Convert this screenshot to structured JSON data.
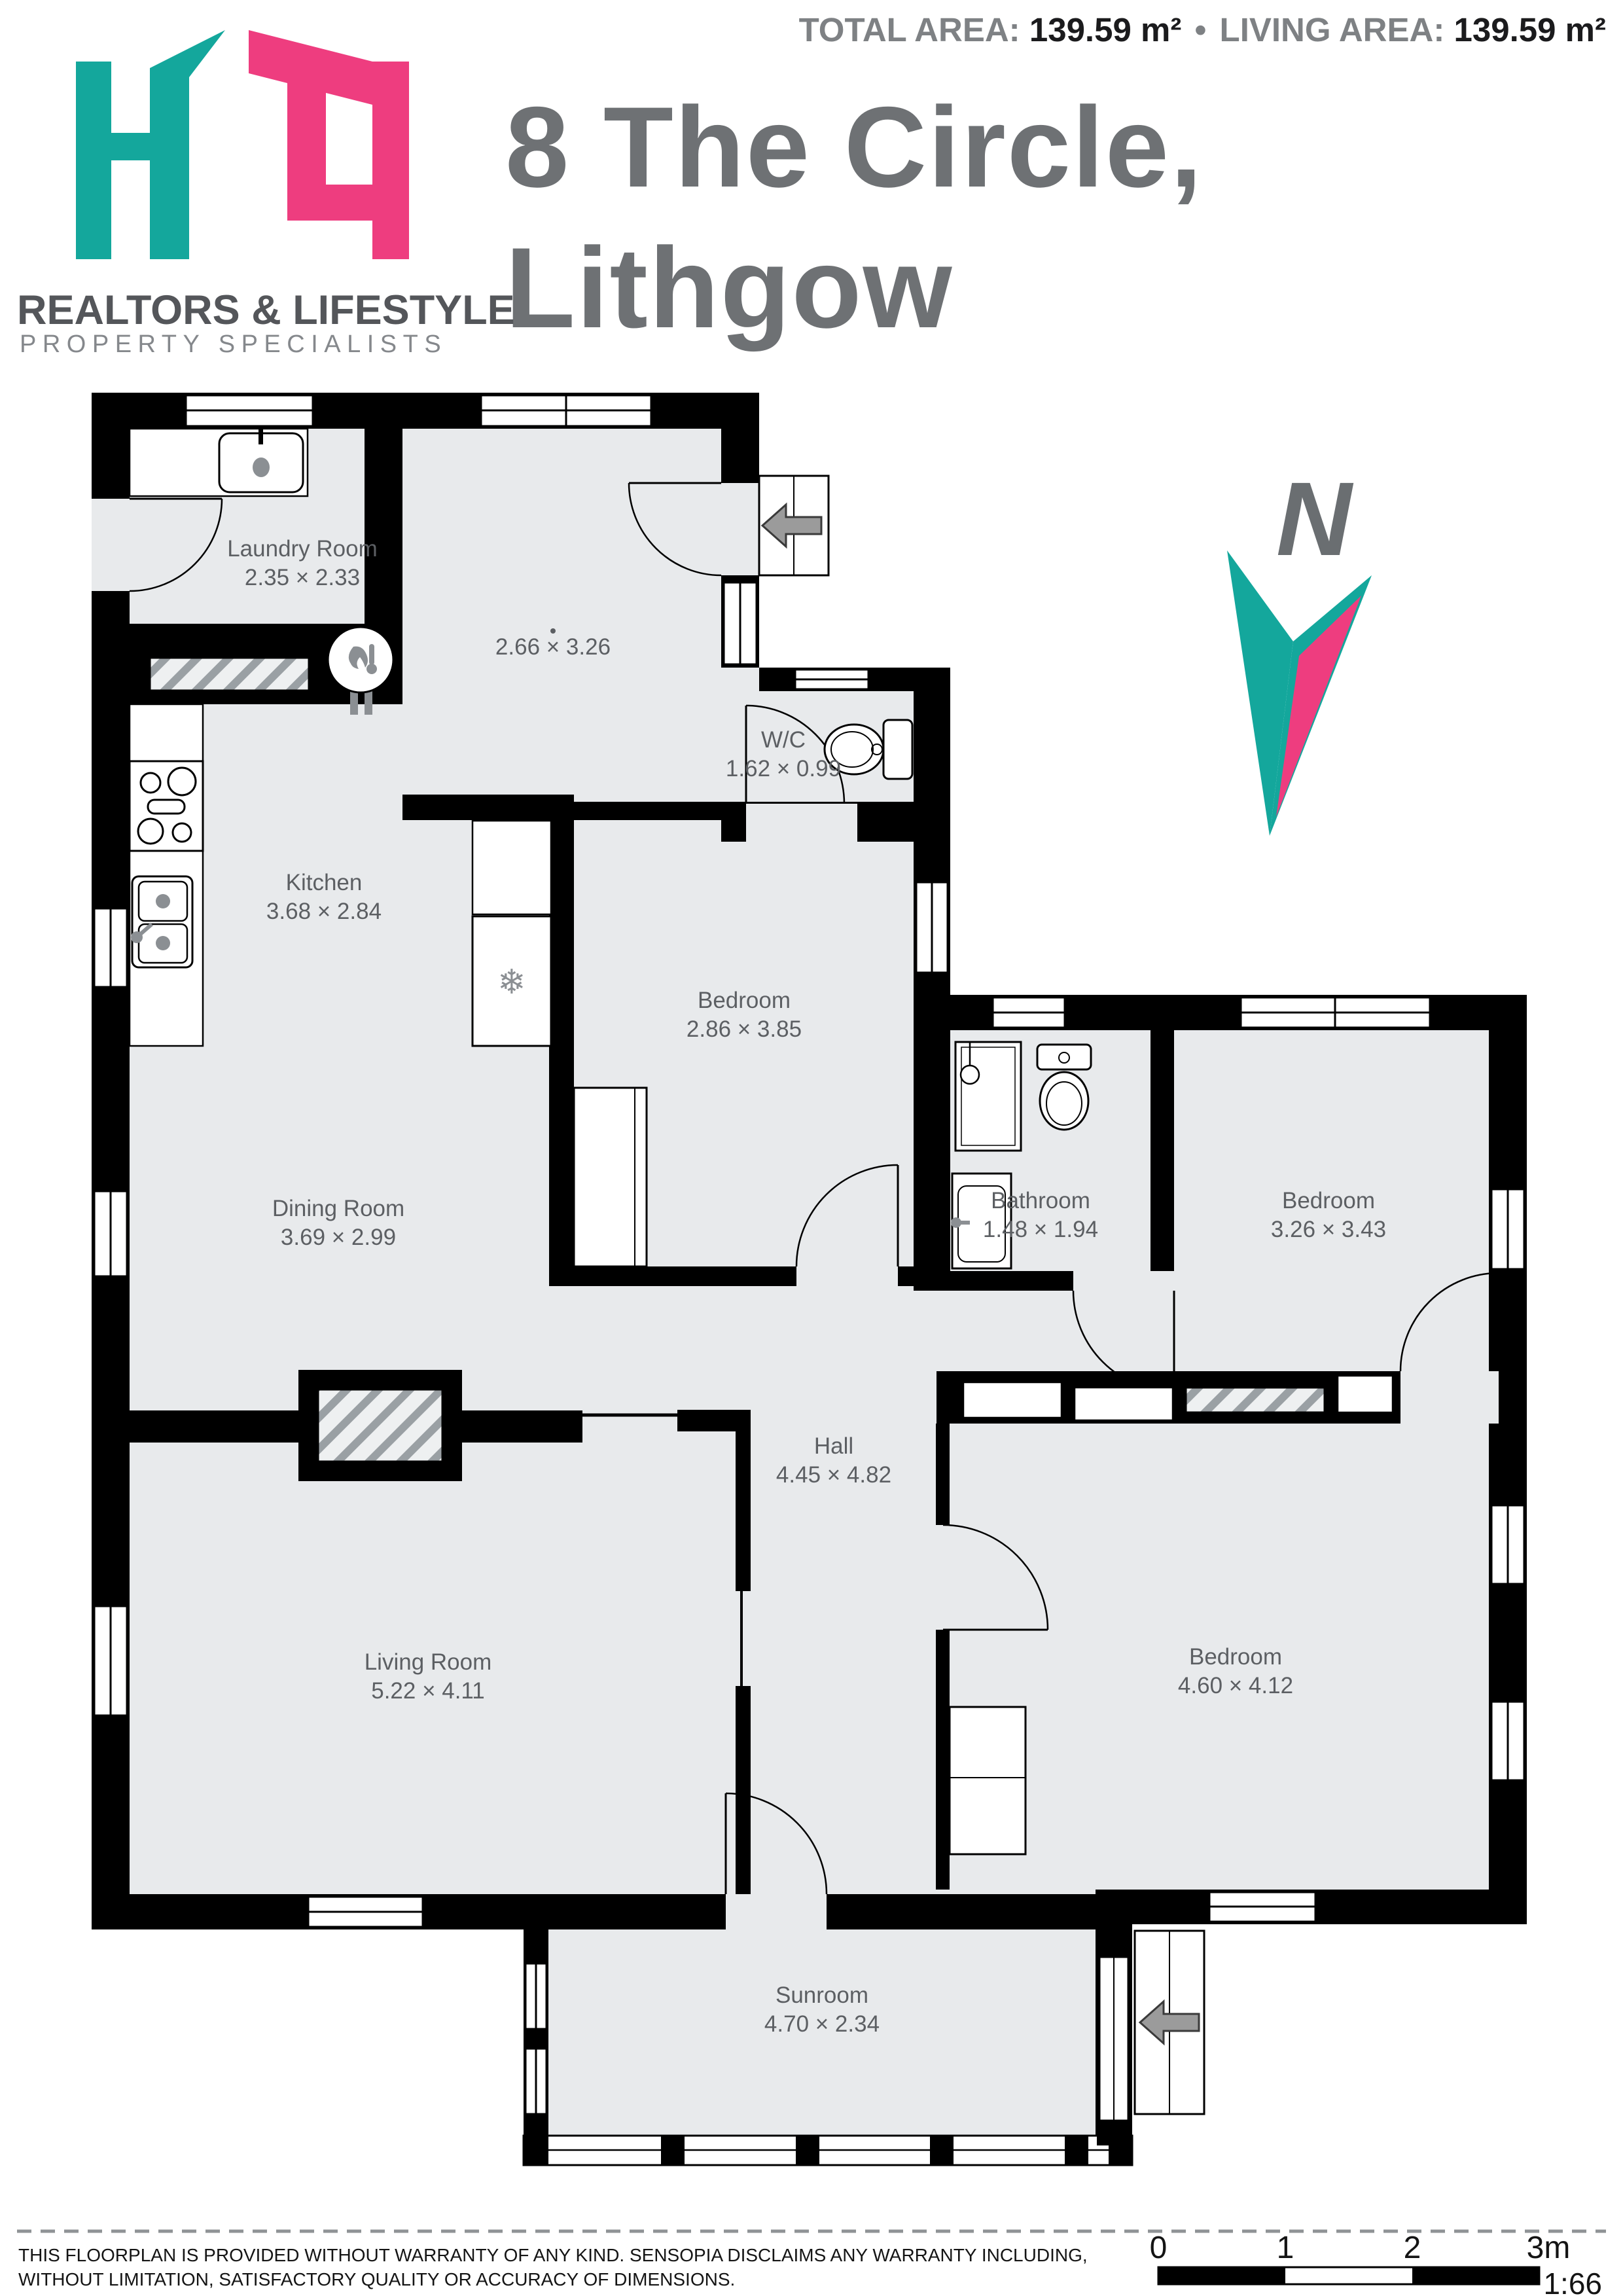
{
  "header": {
    "total_area_label": "TOTAL AREA:",
    "total_area_value": "139.59 m²",
    "separator": "•",
    "living_area_label": "LIVING AREA:",
    "living_area_value": "139.59 m²",
    "title_line1": "8 The Circle,",
    "title_line2": "Lithgow",
    "brand_line1": "REALTORS & LIFESTYLE",
    "brand_line2": "PROPERTY SPECIALISTS"
  },
  "colors": {
    "brand_teal": "#14a79c",
    "brand_pink": "#ee3d7f",
    "wall": "#000000",
    "room_fill": "#e8eaec",
    "label_gray": "#5c5f63",
    "title_gray": "#6e7174"
  },
  "compass": {
    "north_label": "N"
  },
  "icons": {
    "snowflake": "❄"
  },
  "rooms": [
    {
      "name": "Laundry Room",
      "dims": "2.35 × 2.33"
    },
    {
      "name": "",
      "dims": "2.66 × 3.26"
    },
    {
      "name": "W/C",
      "dims": "1.62 × 0.99"
    },
    {
      "name": "Kitchen",
      "dims": "3.68 × 2.84"
    },
    {
      "name": "Bedroom",
      "dims": "2.86 × 3.85"
    },
    {
      "name": "Bathroom",
      "dims": "1.48 × 1.94"
    },
    {
      "name": "Bedroom",
      "dims": "3.26 × 3.43"
    },
    {
      "name": "Dining Room",
      "dims": "3.69 × 2.99"
    },
    {
      "name": "Hall",
      "dims": "4.45 × 4.82"
    },
    {
      "name": "Living Room",
      "dims": "5.22 × 4.11"
    },
    {
      "name": "Bedroom",
      "dims": "4.60 × 4.12"
    },
    {
      "name": "Sunroom",
      "dims": "4.70 × 2.34"
    }
  ],
  "footer": {
    "disclaimer_line1": "THIS FLOORPLAN IS PROVIDED WITHOUT WARRANTY OF ANY KIND. SENSOPIA DISCLAIMS ANY WARRANTY INCLUDING,",
    "disclaimer_line2": "WITHOUT LIMITATION, SATISFACTORY QUALITY OR ACCURACY OF DIMENSIONS.",
    "scale_ticks": [
      "0",
      "1",
      "2",
      "3m"
    ],
    "scale_ratio": "1:66"
  }
}
